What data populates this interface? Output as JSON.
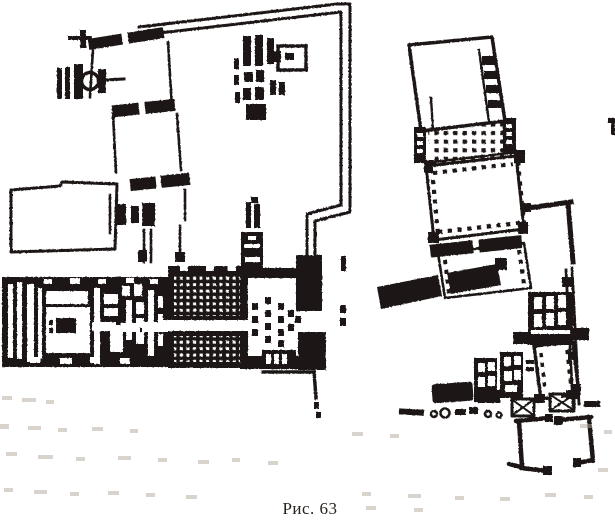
{
  "figure": {
    "caption": "Рис. 63"
  },
  "colors": {
    "paper": "#ffffff",
    "ink": "#1b1712",
    "bleed": "#b3a99b"
  }
}
